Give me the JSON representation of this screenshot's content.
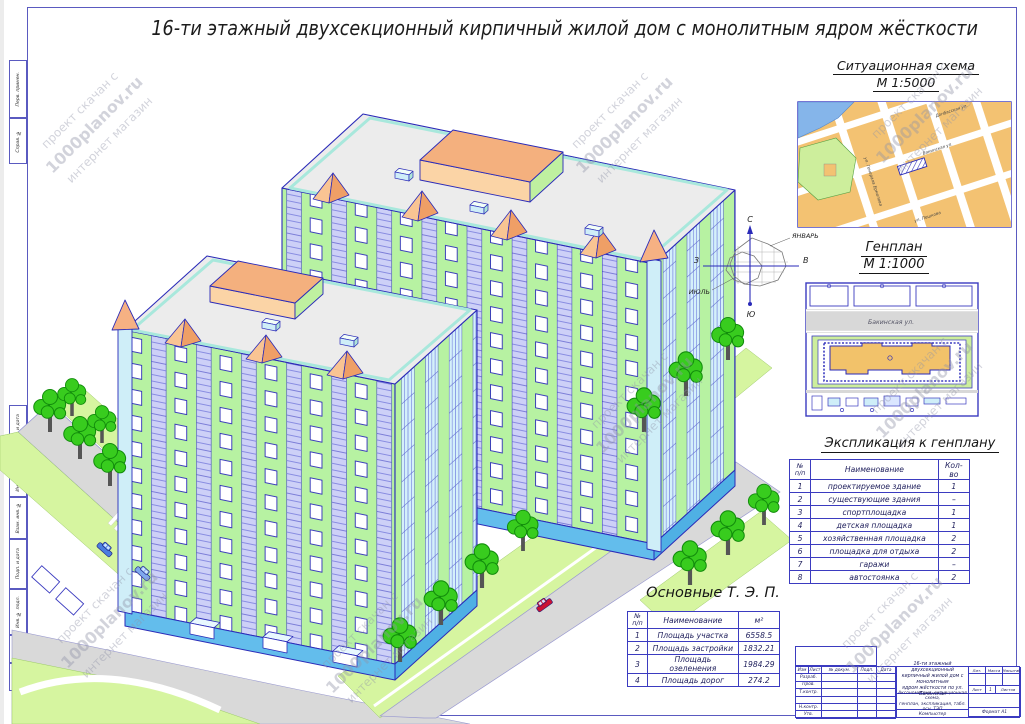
{
  "sheet": {
    "title": "16-ти этажный двухсекционный кирпичный жилой дом с монолитным ядром жёсткости"
  },
  "watermark": {
    "line1": "проект скачан с",
    "line2": "1000planov.ru",
    "line3": "интернет магазин"
  },
  "margin_stamps": [
    "Перв. примен.",
    "Справ. №",
    "Подп. и дата",
    "Инв. № дубл.",
    "Взам. инв. №",
    "Подп. и дата",
    "Инв. № подл."
  ],
  "windrose": {
    "north": "С",
    "south": "Ю",
    "west": "З",
    "east": "В",
    "january": "ЯНВАРЬ",
    "july": "ИЮЛЬ"
  },
  "situational": {
    "heading": "Ситуационная схема",
    "scale": "М 1:5000",
    "streets": [
      "Донбасская ул.",
      "Бакинская ул.",
      "ул. Генерала Ермолова",
      "ул. Пешкова"
    ]
  },
  "genplan": {
    "heading": "Генплан",
    "scale": "М 1:1000",
    "street": "Бакинская ул."
  },
  "explication": {
    "heading": "Экспликация к генплану",
    "col_num_top": "№",
    "col_num_bottom": "п/п",
    "col_name": "Наименование",
    "col_qty": "Кол-во",
    "rows": [
      {
        "num": "1",
        "name": "проектируемое здание",
        "qty": "1"
      },
      {
        "num": "2",
        "name": "существующие здания",
        "qty": "–"
      },
      {
        "num": "3",
        "name": "спортплощадка",
        "qty": "1"
      },
      {
        "num": "4",
        "name": "детская площадка",
        "qty": "1"
      },
      {
        "num": "5",
        "name": "хозяйственная площадка",
        "qty": "2"
      },
      {
        "num": "6",
        "name": "площадка для отдыха",
        "qty": "2"
      },
      {
        "num": "7",
        "name": "гаражи",
        "qty": "–"
      },
      {
        "num": "8",
        "name": "автостоянка",
        "qty": "2"
      }
    ]
  },
  "tep": {
    "heading": "Основные Т. Э. П.",
    "col_num_top": "№",
    "col_num_bottom": "п/п",
    "col_name": "Наименование",
    "col_unit": "м²",
    "rows": [
      {
        "num": "1",
        "name": "Площадь участка",
        "value": "6558.5"
      },
      {
        "num": "2",
        "name": "Площадь застройки",
        "value": "1832.21"
      },
      {
        "num": "3",
        "name": "Площадь озеленения",
        "value": "1984.29"
      },
      {
        "num": "4",
        "name": "Площадь дорог",
        "value": "274.2"
      }
    ]
  },
  "stamp": {
    "col_izm": "Изм",
    "col_list": "Лист",
    "col_doc": "№ докум.",
    "col_podp": "Подп.",
    "col_data": "Дата",
    "row_razrab": "Разраб.",
    "row_prov": "Пров.",
    "row_tkontr": "Т.контр.",
    "row_nkontr": "Н.контр.",
    "row_utv": "Утв.",
    "title_line1": "16-ти этажный двухсекционный",
    "title_line2": "кирпичный жилой дом с монолитным",
    "title_line3": "ядром жёсткости по ул. Бакинская",
    "doc_line1": "Аксонометрия, ситуационная схема,",
    "doc_line2": "генплан, экспликация, табл. осн. ТЭП",
    "lit": "Лит.",
    "massa": "Масса",
    "masshtab": "Масштаб",
    "list_label": "Лист",
    "list_value": "1",
    "listov_label": "Листов",
    "computer": "Компьютер",
    "format": "Формат    А1"
  },
  "colors": {
    "line_blue": "#2a2ab8",
    "facade_green": "#b7f2a2",
    "accent_orange": "#f6b183",
    "glazing_periwinkle": "#cdd0f7",
    "base_blue": "#63bdec",
    "lawn_green": "#d6f5a0",
    "road_gray": "#d9d9d9",
    "map_block_orange": "#f3c272"
  }
}
